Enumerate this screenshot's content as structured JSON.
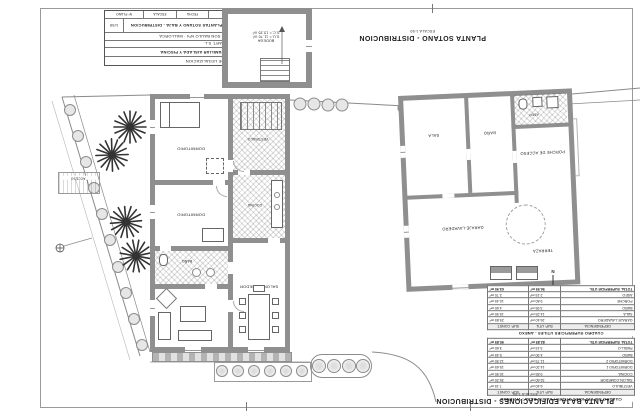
{
  "titles": {
    "sotano": {
      "title": "PLANTA SOTANO - DISTRIBUCION",
      "scale": "ESCALA 1:50"
    },
    "baja": {
      "title": "PLANTA BAJA EDIFICACIONES - DISTRIBUCION",
      "scale": "ESCALA 1:50"
    }
  },
  "title_block": {
    "expediente": "EXPEDIENTE DE LEGALIZACION",
    "project": "VIVIENDA UNIFAMILIAR AISLADA Y PISCINA",
    "promotor": "MALLORCA QUART, S.L.",
    "address": "PARCELA 47A · SON BAULO Nº4 · MALLORCA",
    "sheet_letter": "A",
    "sheet_number": "2",
    "sheet_title": "PLANTAS SOTANO Y BAJA - DISTRIBUCION",
    "scale": "1/50",
    "stamp1": "REF.",
    "stamp2": "FECHA",
    "stamp3": "ESCALA",
    "stamp4": "Nº PLANO"
  },
  "sotano_plan": {
    "room": "BODEGA",
    "area1": "S.U.= 11.70 m²",
    "area2": "S.C.= 15.35 m²"
  },
  "main_plan": {
    "dormitorio1": "DORMITORIO",
    "dormitorio2": "DORMITORIO",
    "bano": "BAÑO",
    "vestibulo": "VESTIBULO",
    "cocina": "COCINA",
    "salon": "SALON-COMEDOR",
    "acceso": "ACCESO"
  },
  "annex_plan": {
    "sala": "SALA",
    "bano": "BAÑO",
    "aseo": "ASEO",
    "porche": "PORCHE DE ACCESO",
    "garaje": "GARAJE-LAVADERO",
    "terraza": "TERRAZA"
  },
  "north_letter": "N",
  "tables": {
    "anexo": {
      "title": "CUADRO SUPERFICIES UTILES - ANEXO",
      "headers": [
        "DEPENDENCIA",
        "SUP. UTIL",
        "SUP. CONST."
      ],
      "rows": [
        [
          "GARAJE-LAVADERO",
          "26.40 m²",
          "29.85 m²"
        ],
        [
          "SALA",
          "14.25 m²",
          "15.90 m²"
        ],
        [
          "BAÑO",
          "3.95 m²",
          "4.60 m²"
        ],
        [
          "PORCHE",
          "9.80 m²",
          "10.45 m²"
        ],
        [
          "ASEO",
          "2.15 m²",
          "2.70 m²"
        ],
        [
          "TOTAL SUPERFICIE UTIL",
          "56.55 m²",
          "63.50 m²"
        ]
      ]
    },
    "vivienda": {
      "title": "CUADRO SUPERFICIES UTILES PLANTA BAJA - VIVIENDA",
      "headers": [
        "DEPENDENCIA",
        "SUP. UTIL",
        "SUP. CONST."
      ],
      "rows": [
        [
          "VESTIBULO",
          "6.40 m²",
          "7.15 m²"
        ],
        [
          "SALON-COMEDOR",
          "32.60 m²",
          "35.20 m²"
        ],
        [
          "COCINA",
          "9.85 m²",
          "10.90 m²"
        ],
        [
          "DORMITORIO 1",
          "14.20 m²",
          "15.65 m²"
        ],
        [
          "DORMITORIO 2",
          "11.75 m²",
          "12.90 m²"
        ],
        [
          "BAÑO",
          "4.90 m²",
          "5.45 m²"
        ],
        [
          "PASILLO",
          "3.15 m²",
          "3.60 m²"
        ],
        [
          "TOTAL SUPERFICIE UTIL",
          "82.85 m²",
          "90.85 m²"
        ]
      ]
    }
  }
}
